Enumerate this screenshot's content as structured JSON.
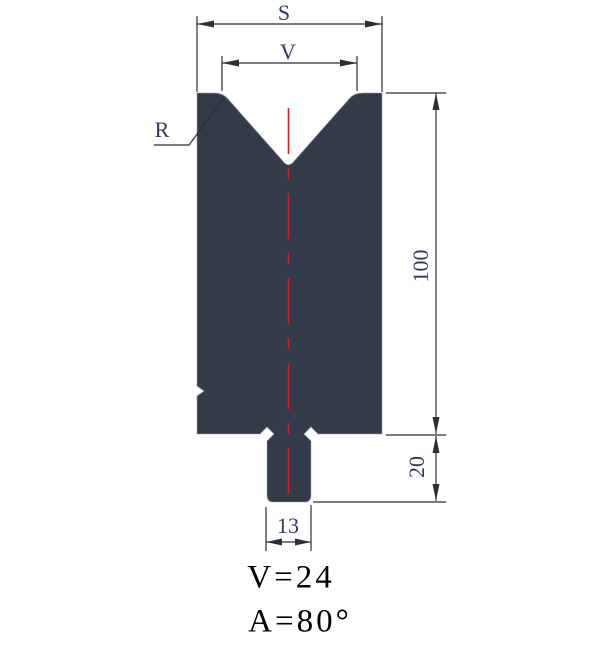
{
  "diagram": {
    "type": "press-brake-v-die-cross-section",
    "dimension_labels": {
      "total_width": "S",
      "vee_opening": "V",
      "corner_radius": "R",
      "body_height": "100",
      "tang_height": "20",
      "tang_width": "13"
    },
    "specs": {
      "vee_size": "V=24",
      "vee_angle": "A=80°"
    },
    "colors": {
      "die_fill": "#333a49",
      "centerline": "#cc2127",
      "dimension_lines": "#2b2f38",
      "dimension_text": "#2a3a60",
      "spec_text": "#000000"
    }
  }
}
